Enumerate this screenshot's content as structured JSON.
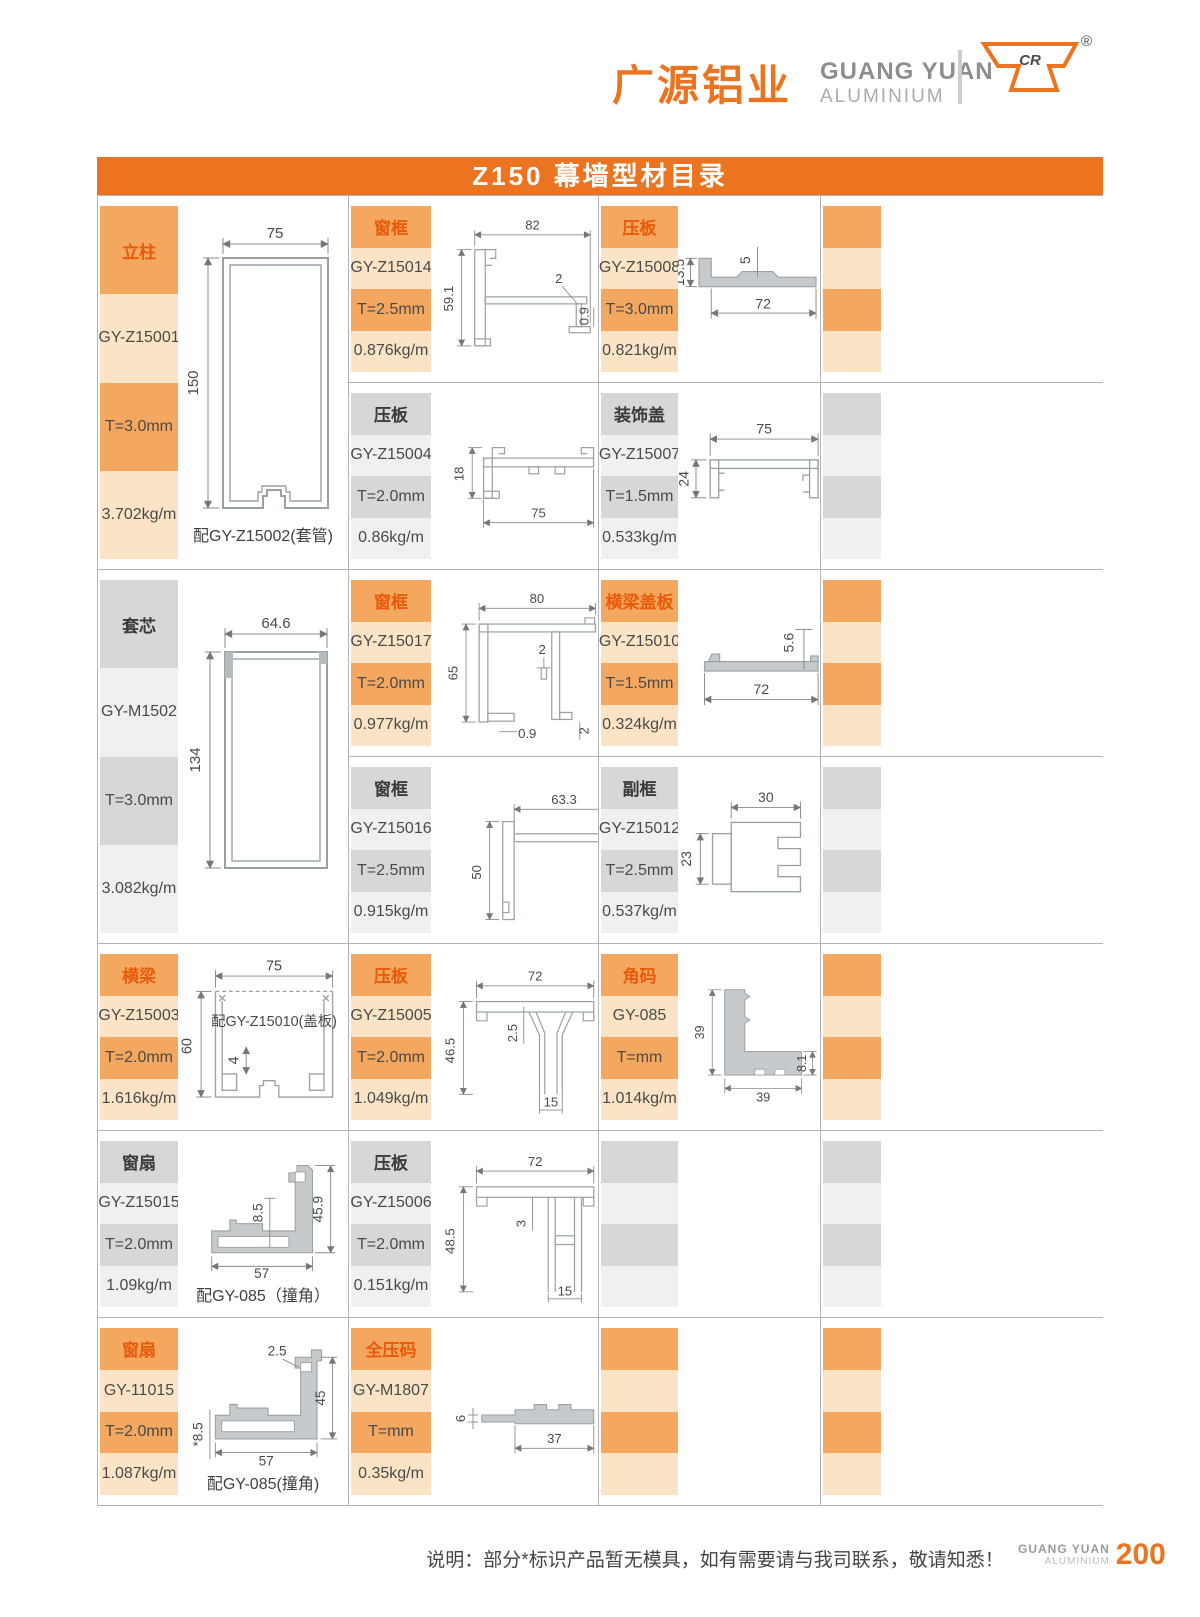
{
  "header": {
    "brand_cn": "广源铝业",
    "brand_en": "GUANG YUAN",
    "brand_sub": "ALUMINIUM",
    "logo_text": "CR",
    "registered": "®"
  },
  "title": "Z150 幕墙型材目录",
  "products": {
    "z15001": {
      "category": "立柱",
      "model": "GY-Z15001",
      "thickness": "T=3.0mm",
      "weight": "3.702kg/m",
      "note": "配GY-Z15002(套管)",
      "dims": {
        "w": "75",
        "h": "150"
      }
    },
    "z15014": {
      "category": "窗框",
      "model": "GY-Z15014",
      "thickness": "T=2.5mm",
      "weight": "0.876kg/m",
      "dims": {
        "w": "82",
        "h": "59.1",
        "t": "2",
        "r": "0.9"
      }
    },
    "z15008": {
      "category": "压板",
      "model": "GY-Z15008",
      "thickness": "T=3.0mm",
      "weight": "0.821kg/m",
      "dims": {
        "h": "13.5",
        "m": "5",
        "w": "72"
      }
    },
    "z15004": {
      "category": "压板",
      "model": "GY-Z15004",
      "thickness": "T=2.0mm",
      "weight": "0.86kg/m",
      "dims": {
        "h": "18",
        "w": "75"
      }
    },
    "z15007": {
      "category": "装饰盖",
      "model": "GY-Z15007",
      "thickness": "T=1.5mm",
      "weight": "0.533kg/m",
      "dims": {
        "w": "75",
        "h": "24"
      }
    },
    "m1502": {
      "category": "套芯",
      "model": "GY-M1502",
      "thickness": "T=3.0mm",
      "weight": "3.082kg/m",
      "dims": {
        "w": "64.6",
        "h": "134"
      }
    },
    "z15017": {
      "category": "窗框",
      "model": "GY-Z15017",
      "thickness": "T=2.0mm",
      "weight": "0.977kg/m",
      "dims": {
        "w": "80",
        "h": "65",
        "t": "2",
        "b": "0.9",
        "r": "2"
      }
    },
    "z15010": {
      "category": "横梁盖板",
      "model": "GY-Z15010",
      "thickness": "T=1.5mm",
      "weight": "0.324kg/m",
      "dims": {
        "h": "5.6",
        "w": "72"
      }
    },
    "z15016": {
      "category": "窗框",
      "model": "GY-Z15016",
      "thickness": "T=2.5mm",
      "weight": "0.915kg/m",
      "dims": {
        "w": "63.3",
        "h": "50",
        "t": "2"
      }
    },
    "z15012": {
      "category": "副框",
      "model": "GY-Z15012",
      "thickness": "T=2.5mm",
      "weight": "0.537kg/m",
      "dims": {
        "w": "30",
        "h": "23"
      }
    },
    "z15003": {
      "category": "横梁",
      "model": "GY-Z15003",
      "thickness": "T=2.0mm",
      "weight": "1.616kg/m",
      "note": "配GY-Z15010(盖板)",
      "dims": {
        "w": "75",
        "h": "60",
        "s": "4"
      }
    },
    "z15005": {
      "category": "压板",
      "model": "GY-Z15005",
      "thickness": "T=2.0mm",
      "weight": "1.049kg/m",
      "dims": {
        "w": "72",
        "h": "46.5",
        "t": "2.5",
        "s": "15"
      }
    },
    "gy085": {
      "category": "角码",
      "model": "GY-085",
      "thickness": "T=mm",
      "weight": "1.014kg/m",
      "dims": {
        "v": "39",
        "w": "39",
        "t": "8.1"
      }
    },
    "z15015": {
      "category": "窗扇",
      "model": "GY-Z15015",
      "thickness": "T=2.0mm",
      "weight": "1.09kg/m",
      "note": "配GY-085（撞角）",
      "dims": {
        "t": "8.5",
        "h": "45.9",
        "w": "57"
      }
    },
    "z15006": {
      "category": "压板",
      "model": "GY-Z15006",
      "thickness": "T=2.0mm",
      "weight": "0.151kg/m",
      "dims": {
        "w": "72",
        "h": "48.5",
        "t": "3",
        "s": "15"
      }
    },
    "gy11015": {
      "category": "窗扇",
      "model": "GY-11015",
      "thickness": "T=2.0mm",
      "weight": "1.087kg/m",
      "note": "配GY-085(撞角)",
      "dims": {
        "t": "2.5",
        "h": "45",
        "w": "57",
        "l": "*8.5"
      }
    },
    "m1807": {
      "category": "全压码",
      "model": "GY-M1807",
      "thickness": "T=mm",
      "weight": "0.35kg/m",
      "dims": {
        "h": "6",
        "w": "37"
      }
    }
  },
  "footer": {
    "note": "说明：部分*标识产品暂无模具，如有需要请与我司联系，敬请知悉！",
    "brand_en": "GUANG YUAN",
    "brand_sub": "ALUMINIUM",
    "page_number": "200"
  },
  "colors": {
    "accent": "#EC7420",
    "category_text": "#E95A0B",
    "orange_block": "#F3A75F",
    "peach_block": "#FBE4C6",
    "gray_block": "#D7D7D7",
    "gray_light_block": "#F0F0F0"
  }
}
